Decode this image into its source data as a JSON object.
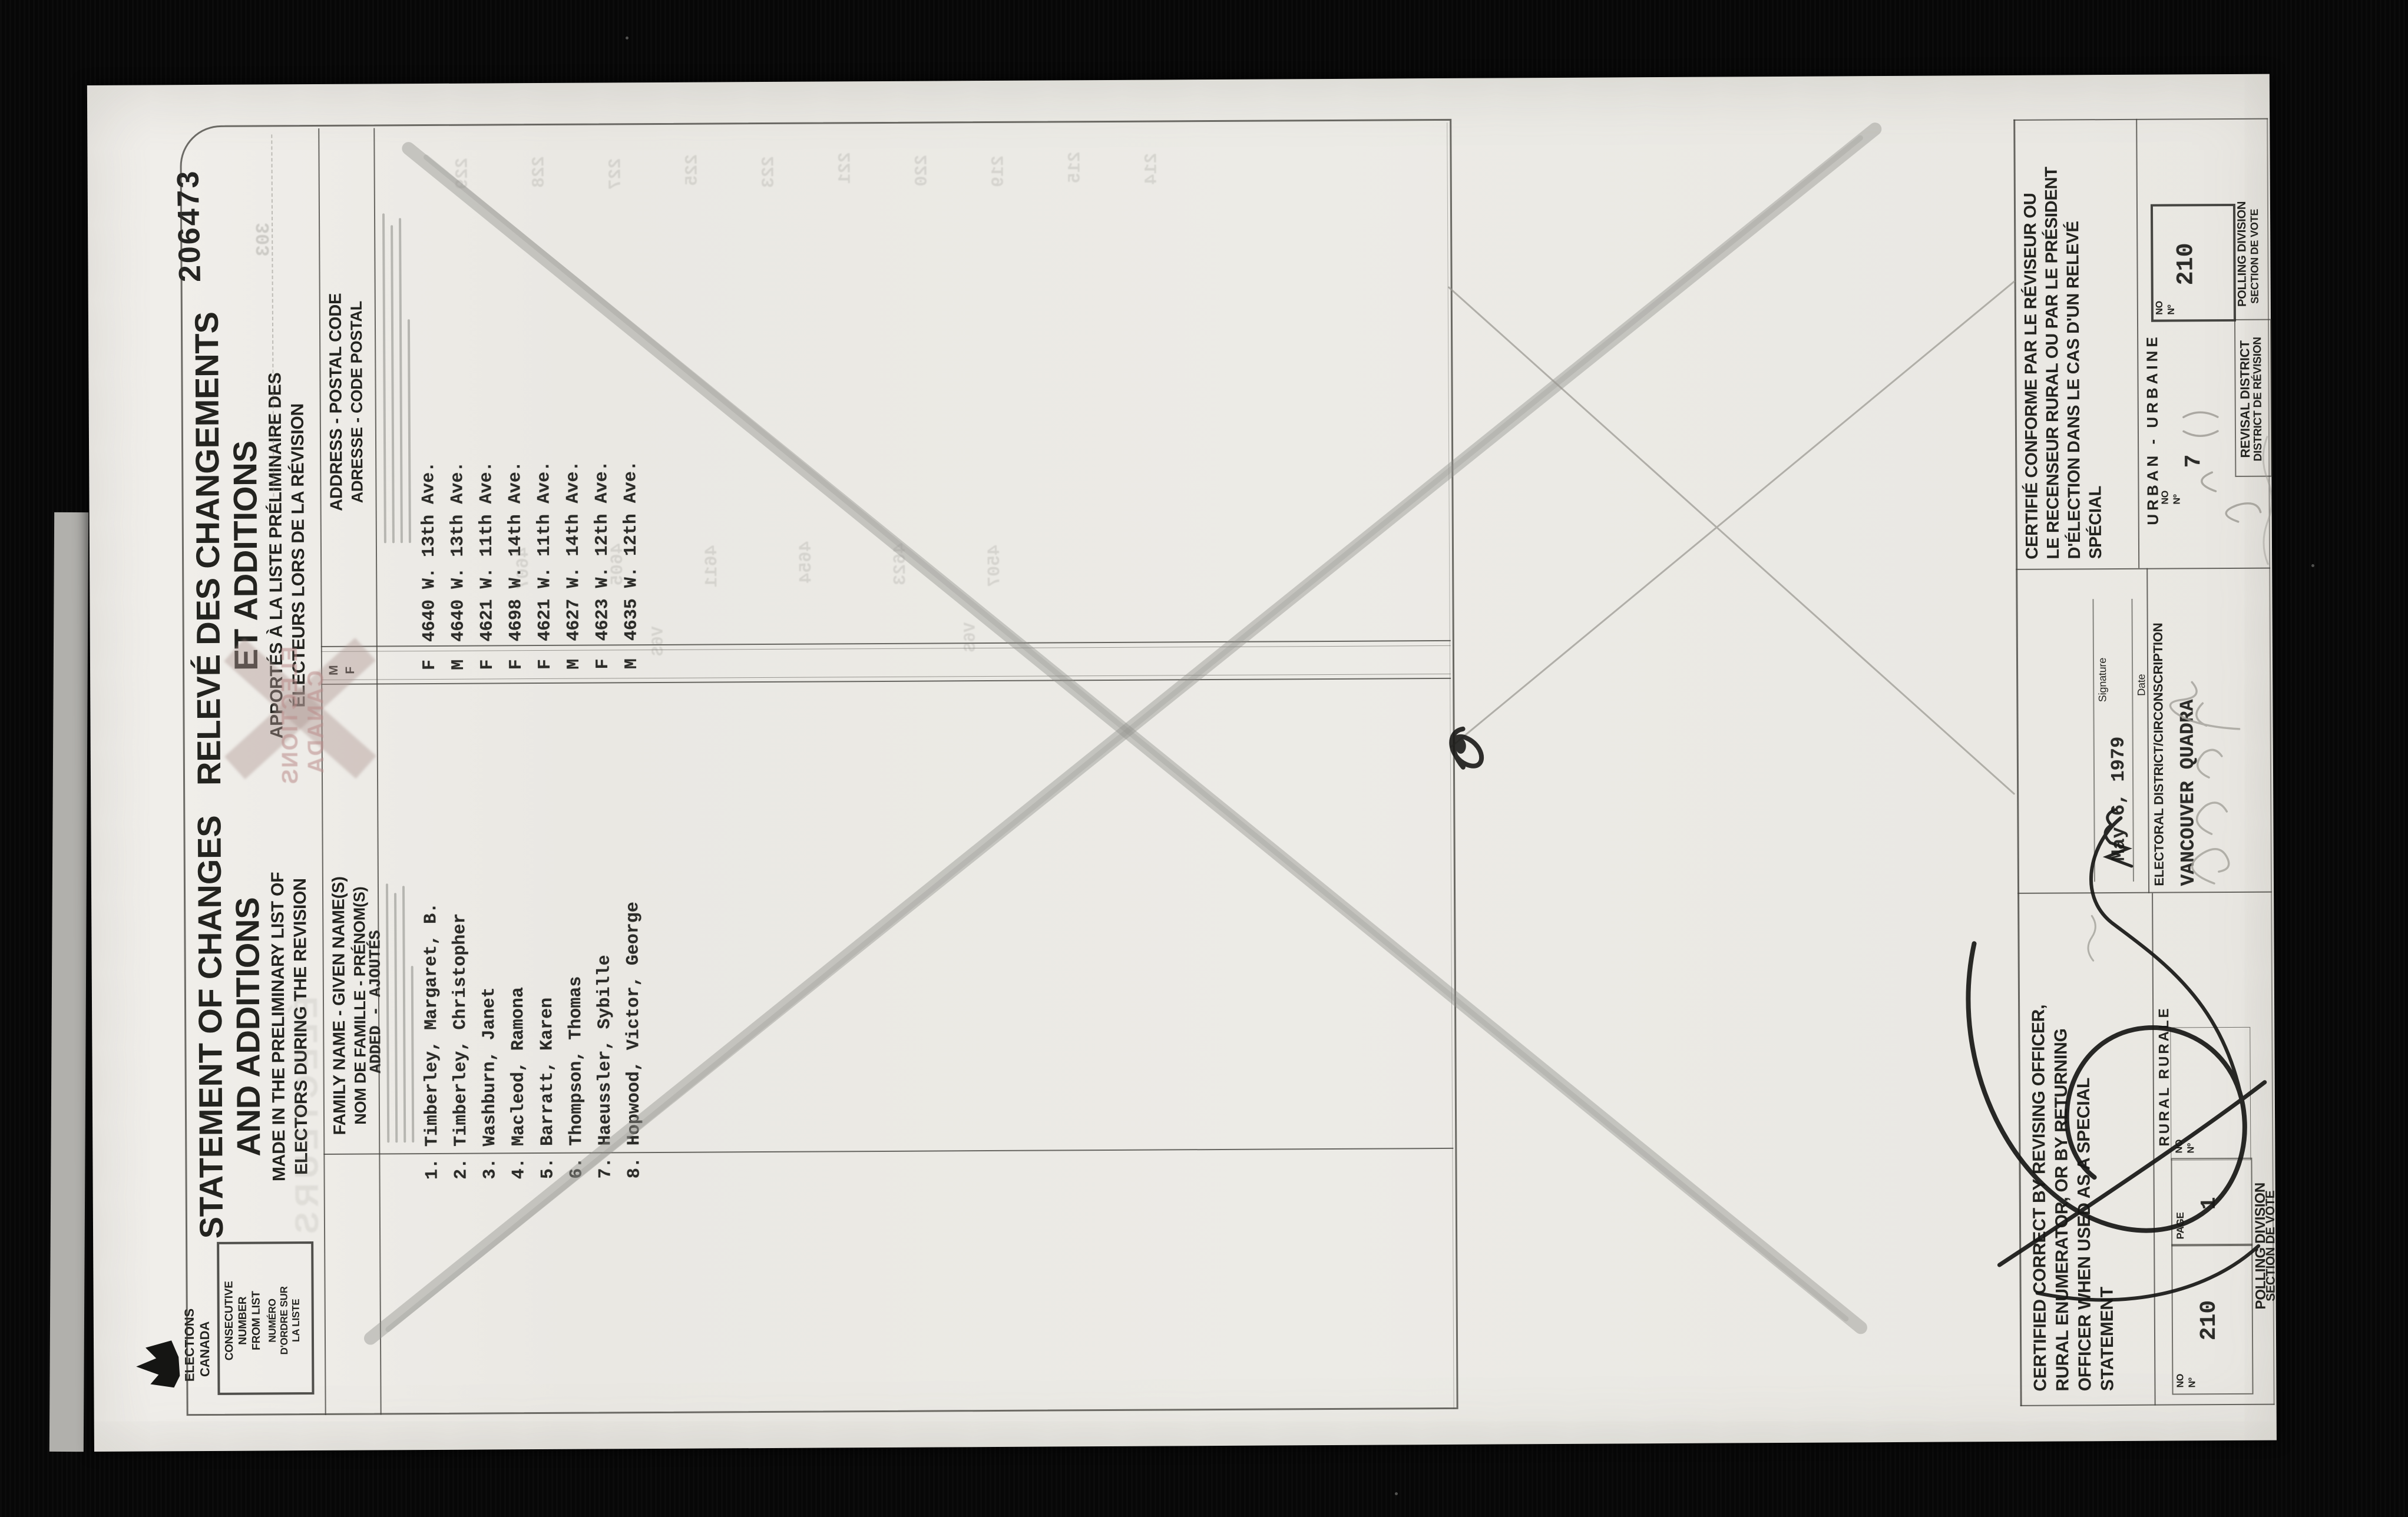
{
  "colors": {
    "background": "#060606",
    "paper": "#ebe9e4",
    "print_ink": "#23231f",
    "typewriter_ink": "#2b2b28",
    "pencil": "#8f8f8a",
    "pink_stamp": "#ba8a88",
    "ghost_bleedthrough": "#7e7d77"
  },
  "stamp": {
    "number": "206473"
  },
  "logo": {
    "line1": "ELECTIONS",
    "line2": "CANADA"
  },
  "titles": {
    "en": {
      "main1": "STATEMENT OF CHANGES",
      "main2": "AND ADDITIONS",
      "sub1": "MADE IN THE PRELIMINARY LIST OF",
      "sub2": "ELECTORS DURING THE REVISION"
    },
    "fr": {
      "main1": "RELEVÉ DES CHANGEMENTS",
      "main2": "ET ADDITIONS",
      "sub1": "APPORTÉS À LA LISTE PRÉLIMINAIRE DES",
      "sub2": "ÉLECTEURS LORS DE LA RÉVISION"
    }
  },
  "table": {
    "consecutive_header": {
      "en1": "CONSECUTIVE",
      "en2": "NUMBER",
      "en3": "FROM LIST",
      "fr1": "NUMÉRO",
      "fr2": "D'ORDRE SUR",
      "fr3": "LA LISTE"
    },
    "name_header": {
      "en": "FAMILY NAME - GIVEN NAME(S)",
      "fr": "NOM DE FAMILLE - PRÉNOM(S)"
    },
    "sex_header": {
      "m": "M",
      "f": "F"
    },
    "address_header": {
      "en": "ADDRESS - POSTAL CODE",
      "fr": "ADRESSE - CODE POSTAL"
    },
    "added_label": "ADDED - AJOUTÉS",
    "rows": [
      {
        "no": "1.",
        "name": "Timberley, Margaret, B.",
        "sex": "F",
        "address": "4640 W. 13th Ave."
      },
      {
        "no": "2.",
        "name": "Timberley, Christopher",
        "sex": "M",
        "address": "4640 W. 13th Ave."
      },
      {
        "no": "3.",
        "name": "Washburn, Janet",
        "sex": "F",
        "address": "4621 W. 11th Ave."
      },
      {
        "no": "4.",
        "name": "Macleod, Ramona",
        "sex": "F",
        "address": "4698 W. 14th Ave."
      },
      {
        "no": "5.",
        "name": "Barratt, Karen",
        "sex": "F",
        "address": "4621 W. 11th Ave."
      },
      {
        "no": "6.",
        "name": "Thompson, Thomas",
        "sex": "M",
        "address": "4627 W. 14th Ave."
      },
      {
        "no": "7.",
        "name": "Haeussler, Sybille",
        "sex": "F",
        "address": "4623 W. 12th Ave."
      },
      {
        "no": "8.",
        "name": "Hopwood, Victor, George",
        "sex": "M",
        "address": "4635 W. 12th Ave."
      }
    ]
  },
  "certification": {
    "en_lines": [
      "CERTIFIED CORRECT BY REVISING OFFICER,",
      "RURAL ENUMERATOR, OR BY RETURNING",
      "OFFICER WHEN USED AS A SPECIAL",
      "STATEMENT"
    ],
    "fr_lines": [
      "CERTIFIÉ CONFORME PAR LE RÉVISEUR OU",
      "LE RECENSEUR RURAL OU PAR LE PRÉSIDENT",
      "D'ÉLECTION DANS LE CAS D'UN RELEVÉ",
      "SPÉCIAL"
    ],
    "signature_label": "Signature",
    "date_label": "Date",
    "date_value": "May 6, 1979",
    "district_label": "ELECTORAL DISTRICT/CIRCONSCRIPTION",
    "district_value": "VANCOUVER QUADRA"
  },
  "footer": {
    "no_label": "NO",
    "no_sup": "Nº",
    "page_label": "PAGE",
    "page_value": "1",
    "rural_label": "RURAL  RURALE",
    "urban_label": "URBAN - URBAINE",
    "polling_line1": "POLLING DIVISION",
    "polling_line2": "SECTION DE VOTE",
    "revisal_line1": "REVISAL DISTRICT",
    "revisal_line2": "DISTRICT DE RÉVISION",
    "rural_no_value": "210",
    "urban_no_value": "210",
    "revisal_no_value": "7"
  },
  "ghost": {
    "stamp_line1": "ELECTIONS",
    "stamp_line2": "CANADA",
    "fragments": [
      "ÉLECTEURS",
      "229",
      "228",
      "227",
      "225",
      "223",
      "221",
      "220",
      "219",
      "215",
      "214",
      "4607",
      "4605",
      "4611",
      "4654",
      "4623",
      "4507",
      "V6S",
      "V6S",
      "303"
    ]
  }
}
